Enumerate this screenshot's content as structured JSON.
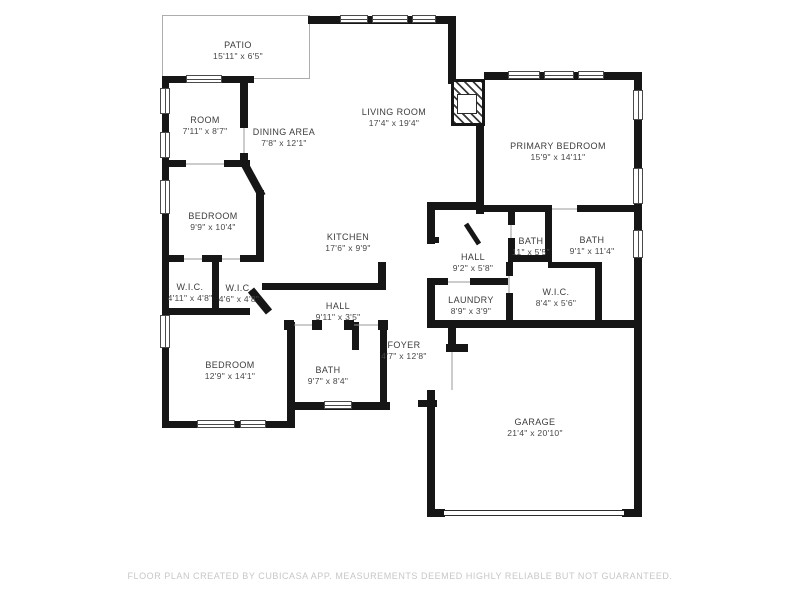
{
  "rooms": [
    {
      "name": "PATIO",
      "dims": "15'11\" x 6'5\""
    },
    {
      "name": "ROOM",
      "dims": "7'11\" x 8'7\""
    },
    {
      "name": "DINING AREA",
      "dims": "7'8\" x 12'1\""
    },
    {
      "name": "LIVING ROOM",
      "dims": "17'4\" x 19'4\""
    },
    {
      "name": "PRIMARY BEDROOM",
      "dims": "15'9\" x 14'11\""
    },
    {
      "name": "BEDROOM",
      "dims": "9'9\" x 10'4\""
    },
    {
      "name": "KITCHEN",
      "dims": "17'6\" x 9'9\""
    },
    {
      "name": "BATH",
      "dims": "11\" x 5'5\""
    },
    {
      "name": "BATH",
      "dims": "9'1\" x 11'4\""
    },
    {
      "name": "HALL",
      "dims": "9'2\" x 5'8\""
    },
    {
      "name": "W.I.C.",
      "dims": "4'11\" x 4'8\""
    },
    {
      "name": "W.I.C.",
      "dims": "4'6\" x 4'8\""
    },
    {
      "name": "W.I.C.",
      "dims": "8'4\" x 5'6\""
    },
    {
      "name": "LAUNDRY",
      "dims": "8'9\" x 3'9\""
    },
    {
      "name": "HALL",
      "dims": "9'11\" x 3'5\""
    },
    {
      "name": "FOYER",
      "dims": "4'7\" x 12'8\""
    },
    {
      "name": "BEDROOM",
      "dims": "12'9\" x 14'1\""
    },
    {
      "name": "BATH",
      "dims": "9'7\" x 8'4\""
    },
    {
      "name": "GARAGE",
      "dims": "21'4\" x 20'10\""
    }
  ],
  "footer": {
    "disclaimer": "FLOOR PLAN CREATED BY CUBICASA APP. MEASUREMENTS DEEMED HIGHLY RELIABLE BUT NOT GUARANTEED."
  },
  "colors": {
    "wall": "#161616",
    "background": "#ffffff",
    "footer_text": "#c7c7c7"
  }
}
